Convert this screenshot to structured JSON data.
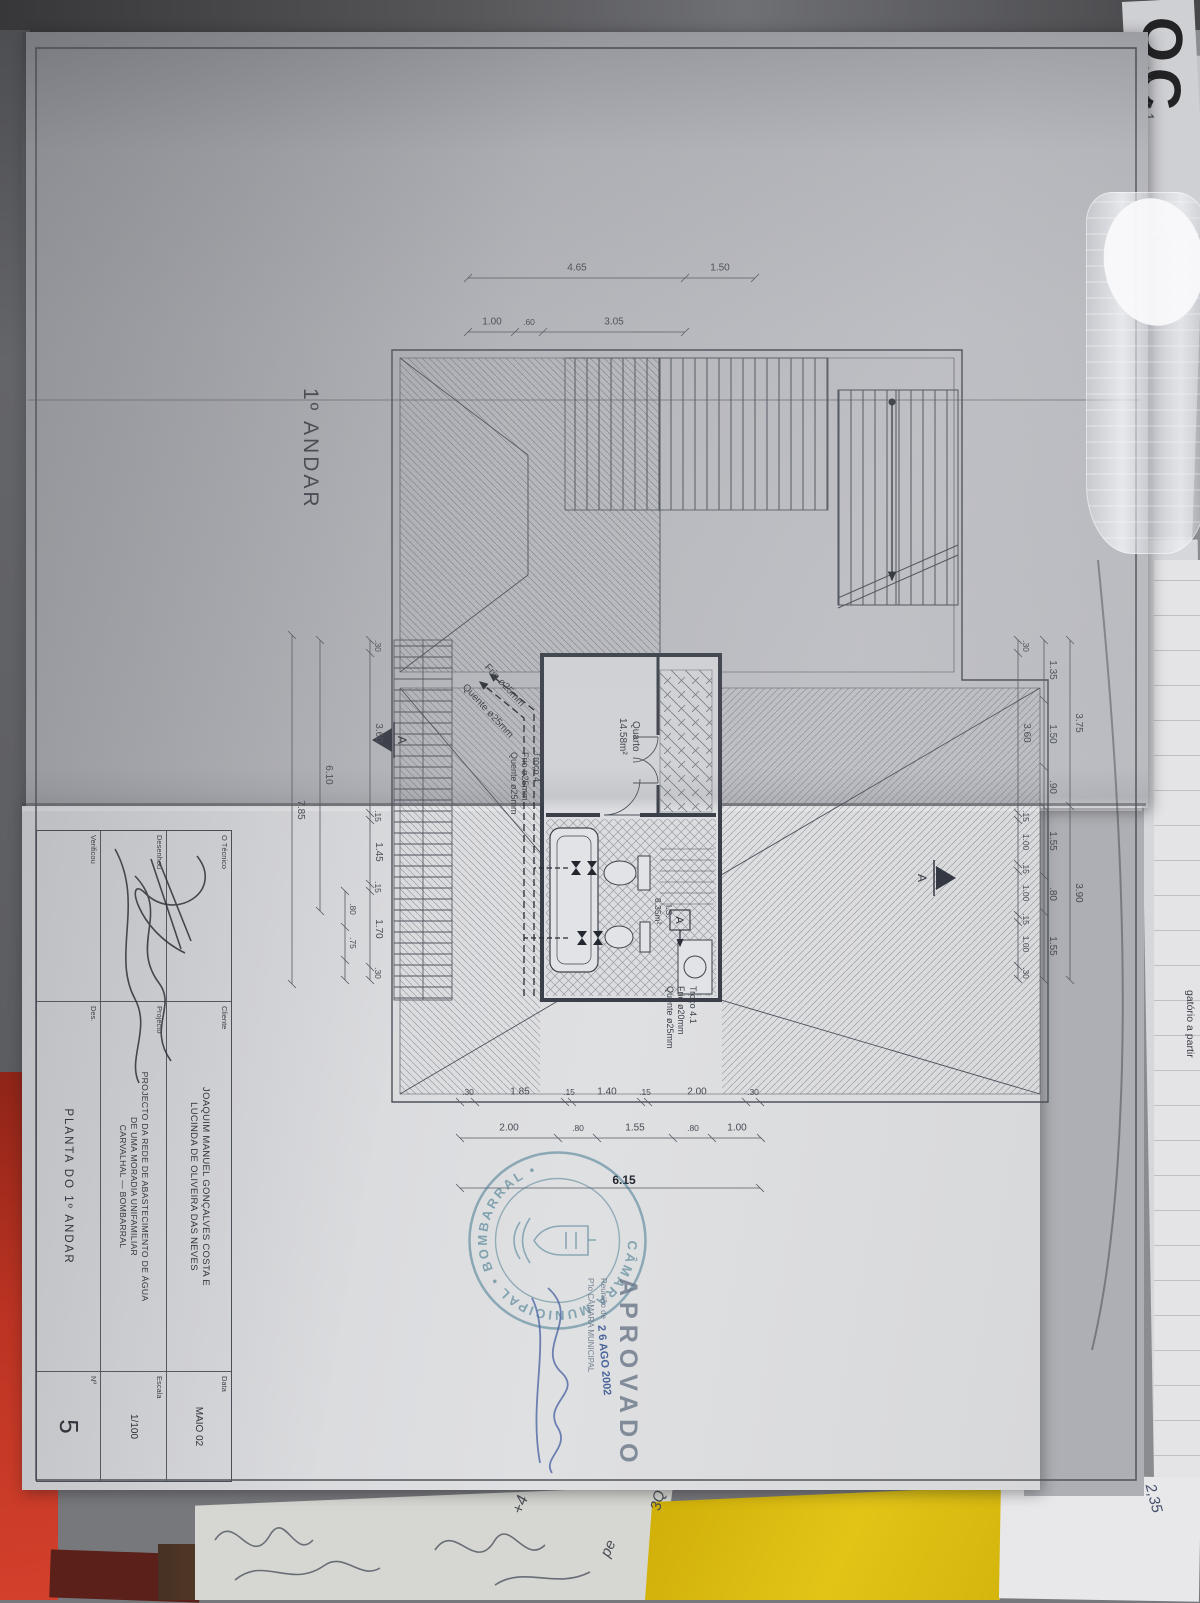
{
  "sheet": {
    "floor_label": "1º ANDAR",
    "title_block": {
      "technician_label": "O Técnico",
      "drew_label": "Desenhou",
      "checked_label": "Verificou",
      "des_label": "Des.",
      "client_label": "Cliente",
      "project_label": "Projecto",
      "client_lines": [
        "JOAQUIM MANUEL GONÇALVES COSTA E",
        "LUCINDA DE OLIVEIRA DAS NEVES"
      ],
      "project_lines": [
        "PROJECTO DA REDE DE ABASTECIMENTO DE ÁGUA",
        "DE UMA MORADIA UNIFAMILIAR",
        "CARVALHAL — BOMBARRAL"
      ],
      "drawing_title": "PLANTA DO 1º ANDAR",
      "date_label": "Data",
      "date_value": "MAIO 02",
      "scale_label": "Escala",
      "scale_value": "1/100",
      "number_label": "Nº",
      "number_value": "5"
    },
    "stamps": {
      "approved": "APROVADO",
      "meeting_line": "Reunião de",
      "date_stamp": "2 6 AGO 2002",
      "by_line": "P'lo CÂMARA MUNICIPAL",
      "round_stamp_text": "CÂMARA MUNICIPAL • BOMBARRAL •",
      "stamp_blue": "#3f7a94",
      "approved_gray": "#6d7f94"
    },
    "plan": {
      "room1_name": "Quarto",
      "room1_area": "14.58m²",
      "room2_name": "I.S.",
      "room2_area": "8.35m²",
      "pipe_cold": "Frio ø25mm",
      "pipe_hot": "Quente ø25mm",
      "segment4": [
        "Troço 4",
        "Frio ø25mm",
        "Quente ø25mm"
      ],
      "segment41": [
        "Troço 4.1",
        "Frio ø20mm",
        "Quente ø25mm"
      ],
      "section_marker": "A"
    },
    "dims": {
      "top_row1": [
        "3.75",
        "3.90"
      ],
      "top_row2": [
        "1.35",
        "1.50",
        ".90",
        "1.55",
        ".80",
        "1.55"
      ],
      "top_row3": [
        ".30",
        "3.60",
        ".15",
        "1.00",
        ".15",
        "1.00",
        ".15",
        "1.00",
        ".30"
      ],
      "left_outer": [
        "1.50",
        "4.65"
      ],
      "left_inner": [
        "3.05",
        ".60",
        "1.00"
      ],
      "bottom_row1": [
        ".30",
        "3.60",
        ".15",
        "1.45",
        ".15",
        "1.70",
        ".30"
      ],
      "bottom_row1b": [
        ".80",
        ".75"
      ],
      "bottom_total1": "6.10",
      "bottom_total2": "7.85",
      "right_row1": [
        ".30",
        "2.00",
        ".15",
        "1.40",
        ".15",
        "1.85",
        ".30"
      ],
      "right_row2": [
        "1.00",
        ".80",
        "1.55",
        ".80",
        "2.00"
      ],
      "right_total": "6.15"
    }
  },
  "surroundings": {
    "sticky_note_color": "#d9ba10",
    "red_folder_color": "#b5301f",
    "edge_chars": "OC",
    "numbers_top": [
      "1,4)/4",
      "18,1"
    ],
    "edge_text": "gatório a partir",
    "bottom_right_number": "2,35",
    "handwriting": [
      "+4",
      "pe",
      "3Q"
    ]
  }
}
